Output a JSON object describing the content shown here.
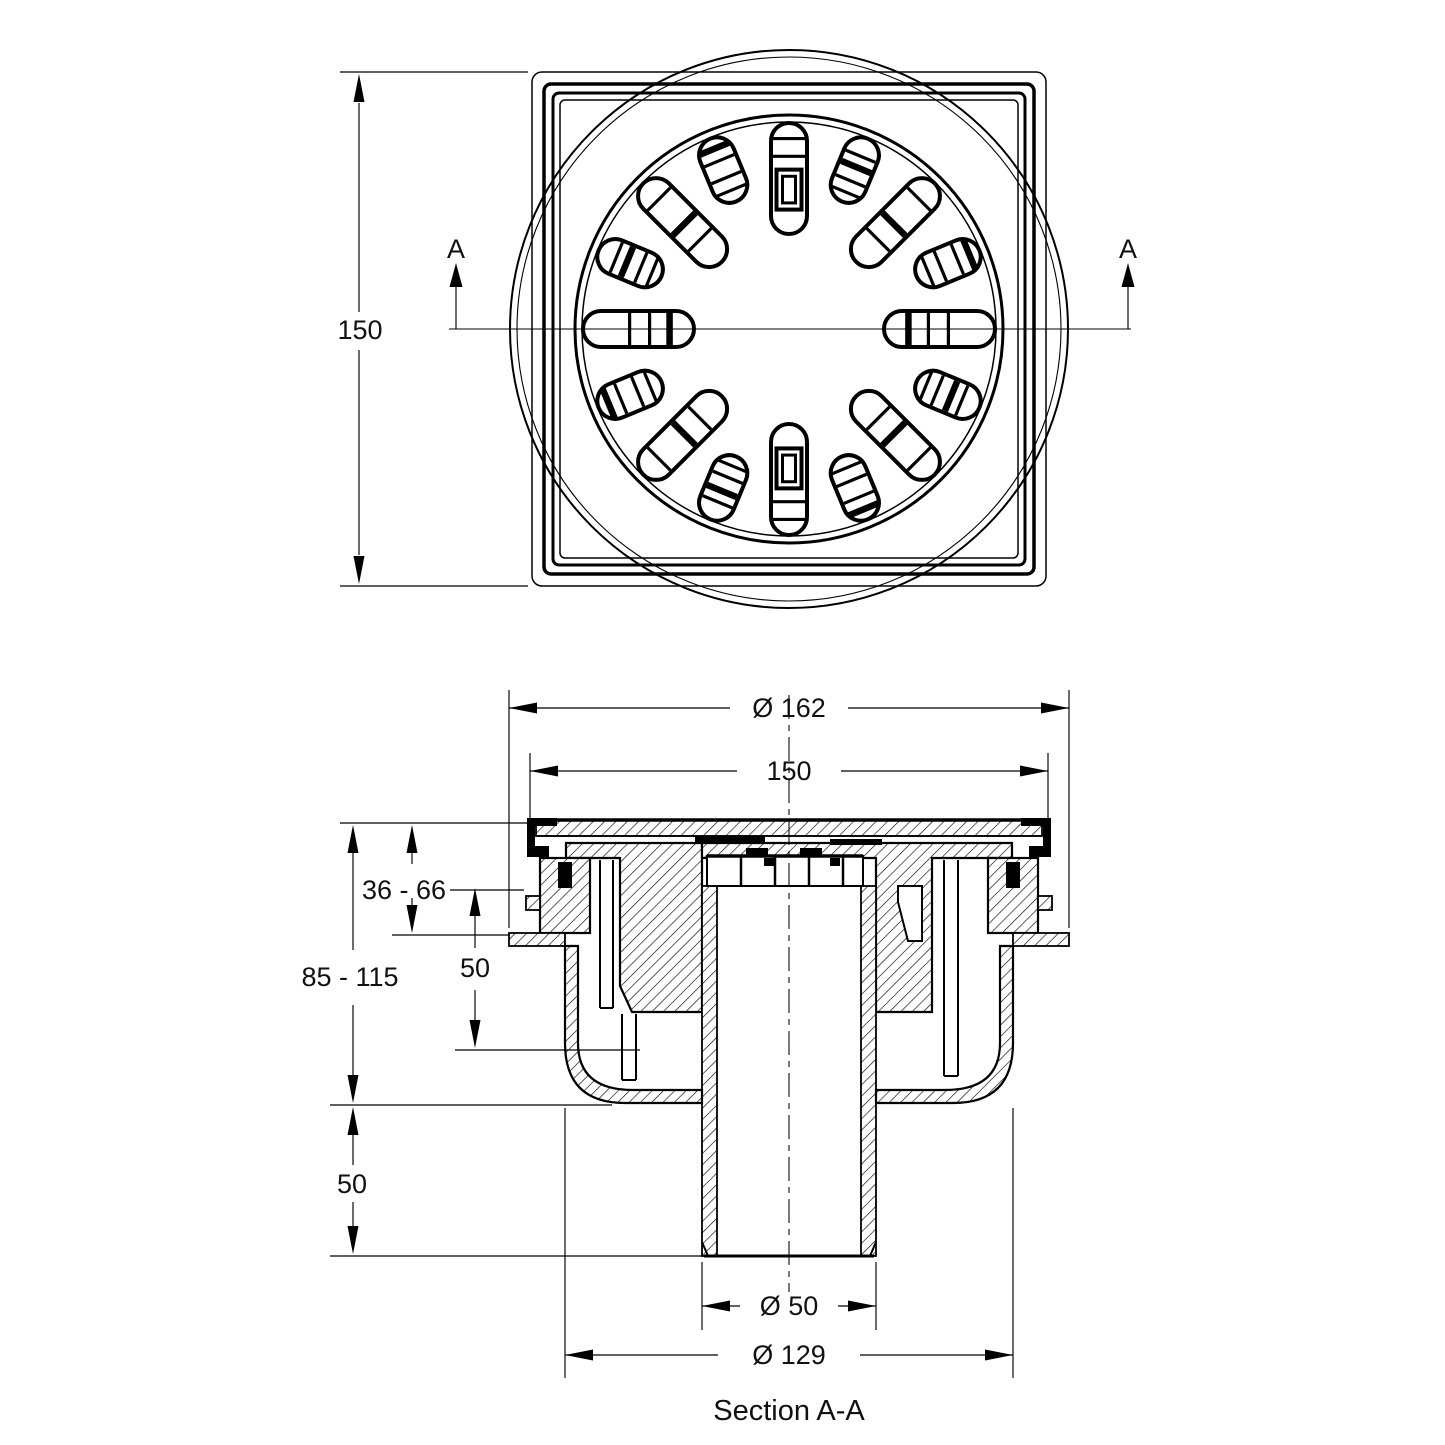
{
  "colors": {
    "ink": "#000000",
    "paper": "#ffffff"
  },
  "top_view": {
    "dim_height": "150",
    "section_label_left": "A",
    "section_label_right": "A",
    "grate": {
      "slot_count": 16,
      "inner_radius_cardinal": 95,
      "inner_radius_diagonal": 138,
      "outer_radius": 206,
      "slot_width": 36
    }
  },
  "section_view": {
    "dim_outer_flange": "Ø 162",
    "dim_top_width": "150",
    "dim_install_depth": "36 - 66",
    "dim_total_height": "85 - 115",
    "dim_trap_depth": "50",
    "dim_spigot_length": "50",
    "dim_outlet": "Ø 50",
    "dim_body": "Ø 129",
    "caption": "Section A-A"
  }
}
